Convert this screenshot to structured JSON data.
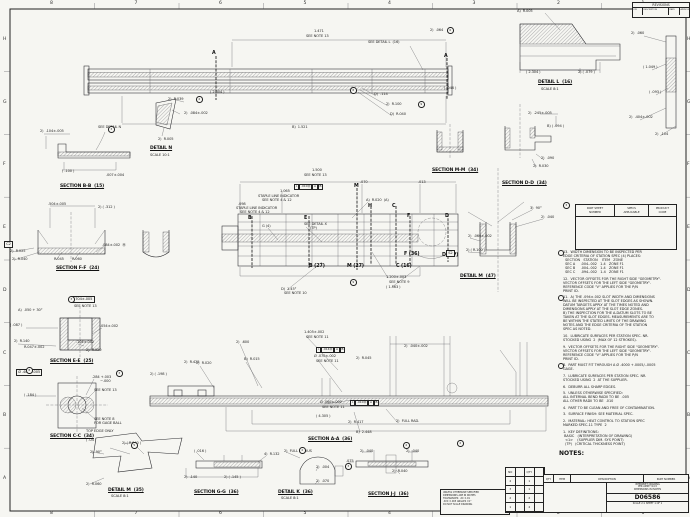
{
  "sheet": {
    "bg": "#f6f6f2",
    "line_color": "#26262a",
    "drawing_number": "D06586"
  },
  "zones": {
    "top": [
      "8",
      "7",
      "6",
      "5",
      "4",
      "3",
      "2",
      "1"
    ],
    "bottom": [
      "8",
      "7",
      "6",
      "5",
      "4",
      "3",
      "2",
      "1"
    ],
    "left": [
      "H",
      "G",
      "F",
      "E",
      "D",
      "C",
      "B",
      "A"
    ],
    "right": [
      "H",
      "G",
      "F",
      "E",
      "D",
      "C",
      "B",
      "A"
    ]
  },
  "revisions": {
    "title": "REVISIONS",
    "cols": [
      "LTR",
      "DESCRIPTION",
      "DATE",
      "APPROVED"
    ]
  },
  "spec_table": {
    "headers": [
      "PART SHEET\nNUMBER",
      "SPECS\nAPPLICABLE",
      "PRODUCT\nCODE"
    ]
  },
  "notes": {
    "heading": "NOTES:",
    "items": [
      {
        "flag": true,
        "text": "13.  WIDTH DIMENSION TO BE INSPECTED PER\nEDGE CRITERIA OF STATION SPEC (4) PLACES:\n  SECTION   STATION    ITEM   ZONE\n  SEC A     .004-.002   1-4   ZONE F1\n  SEC B     .004-.002   1-4   ZONE F1\n  SEC C     .094-.002   1-4   ZONE F1"
      },
      {
        "flag": false,
        "text": "12.  VECTOR OFFSETS FOR THE RIGHT SIDE \"GEOMETRY\".\nVECTOR OFFSETS FOR THE LEFT SIDE \"GEOMETRY\".\nREFERENCE CODE \"V\" APPLIES FOR THE P/N\nPRINT ID."
      },
      {
        "flag": true,
        "text": "11.  A) THE .094±.002 SLOT WIDTH AND DIMENSIONS\nWILL BE INSPECTED AT THE SLOT EDGES AS SHOWN.\nDATUM TARGETS APPLY AT THE TIMES NOTED AND\nDIMENSIONS APPLY AT THE SLOT EDGE ZONES.\nB) THE INSPECTION FOR THE A-DATUM SLOTS TO BE\nTAKEN AT THE SLOT EDGES. MEASUREMENTS ARE TO\nBE WITHIN THE STATED LIMITS OF THE DRAWING\nNOTES AND THE EDGE CRITERIA OF THE STATION\nSPEC AS NOTED."
      },
      {
        "flag": false,
        "text": "10.  LUBRICATE SURFACES PER STATION SPEC. NR.\nSTOCKED USING  2  (MAX OF 12 STROKES)."
      },
      {
        "flag": false,
        "text": "9.  VECTOR OFFSETS FOR THE RIGHT SIDE \"GEOMETRY\".\nVECTOR OFFSETS FOR THE LEFT SIDE \"GEOMETRY\".\nREFERENCE CODE \"V\" APPLIES FOR THE P/N\nPRINT ID."
      },
      {
        "flag": true,
        "text": "8.  PART MUST FIT THROUGH A Ø .4000 +.0005/-.0005\nGAGE."
      },
      {
        "flag": false,
        "text": "7.  LUBRICATE SURFACES PER STATION SPEC. NR.\nSTOCKED USING  2  AT THE SUPPLIER."
      },
      {
        "flag": false,
        "text": "6.  DEBURR ALL SHARP EDGES."
      },
      {
        "flag": false,
        "text": "5.  UNLESS OTHERWISE SPECIFIED:\nALL INTERNAL BEND RADII TO BE  .005\nALL OTHER RADII TO BE  .010"
      },
      {
        "flag": false,
        "text": "4.  PART TO BE CLEAN AND FREE OF CONTAMINATION."
      },
      {
        "flag": false,
        "text": "3.  SURFACE FINISH: SEE MATERIAL SPEC."
      },
      {
        "flag": false,
        "text": "2.  MATERIAL: HEAT CONTROL TO STATION SPEC\nMARKED SPEC-11 TYPE  2"
      },
      {
        "flag": false,
        "text": "1.  KEY DEFINITIONS:\n BASIC   (INTERPRETATION OF DRAWING)\n  <1>    (SUPPLIER DIM. SYS POINT)\n  (TP)   (CRITICAL THICKNESS POINT)"
      }
    ]
  },
  "labels": [
    {
      "t": "1.471",
      "x": 314,
      "y": 30
    },
    {
      "t": "SEE NOTE 13",
      "x": 306,
      "y": 35
    },
    {
      "t": "SEE DETAIL L  (16)",
      "x": 368,
      "y": 41
    },
    {
      "t": "2)  .064",
      "x": 430,
      "y": 29
    },
    {
      "t": "( 2.304 )",
      "x": 210,
      "y": 91
    },
    {
      "t": "B)  1.521",
      "x": 292,
      "y": 126
    },
    {
      "t": "D)  .114",
      "x": 374,
      "y": 93
    },
    {
      "t": "2)  R.100",
      "x": 386,
      "y": 103
    },
    {
      "t": "D)  R.040",
      "x": 390,
      "y": 113
    },
    {
      "t": "( .046 )",
      "x": 444,
      "y": 87
    },
    {
      "t": "A",
      "x": 212,
      "y": 52,
      "k": "cut"
    },
    {
      "t": "A",
      "x": 444,
      "y": 55,
      "k": "cut"
    },
    {
      "t": "A)  R.005",
      "x": 517,
      "y": 10
    },
    {
      "t": "2)  .060",
      "x": 631,
      "y": 32
    },
    {
      "t": "( 1.049 )",
      "x": 643,
      "y": 66
    },
    {
      "t": "( .093 )",
      "x": 649,
      "y": 91
    },
    {
      "t": "2)  .404±.002",
      "x": 629,
      "y": 116
    },
    {
      "t": "2)  .104",
      "x": 655,
      "y": 133
    },
    {
      "t": "( 2.304 )",
      "x": 526,
      "y": 71
    },
    {
      "t": "2) ( .079 )",
      "x": 578,
      "y": 71
    },
    {
      "t": "DETAIL L  (16)",
      "x": 538,
      "y": 81,
      "k": "sec"
    },
    {
      "t": "SCALE 8:1",
      "x": 541,
      "y": 88
    },
    {
      "t": "SEE DETAIL N",
      "x": 98,
      "y": 126
    },
    {
      "t": "2)  .104±.005",
      "x": 40,
      "y": 130
    },
    {
      "t": "( .100 )",
      "x": 62,
      "y": 170
    },
    {
      "t": ".007±.004",
      "x": 106,
      "y": 174
    },
    {
      "t": "SECTION B-B  (15)",
      "x": 60,
      "y": 185,
      "k": "sec"
    },
    {
      "t": "2)  R.039",
      "x": 168,
      "y": 98
    },
    {
      "t": "2)  .084±.002",
      "x": 184,
      "y": 112
    },
    {
      "t": "2)  R.005",
      "x": 158,
      "y": 138
    },
    {
      "t": "DETAIL N",
      "x": 150,
      "y": 147,
      "k": "sec"
    },
    {
      "t": "SCALE 10:1",
      "x": 150,
      "y": 154
    },
    {
      "t": "SECTION M-M  (34)",
      "x": 432,
      "y": 169,
      "k": "sec"
    },
    {
      "t": "2)  .245±.005",
      "x": 528,
      "y": 112
    },
    {
      "t": "B) ( .094 )",
      "x": 547,
      "y": 125
    },
    {
      "t": "2)  .090",
      "x": 541,
      "y": 157
    },
    {
      "t": "2)  R.030",
      "x": 533,
      "y": 165
    },
    {
      "t": "SECTION D-D  (34)",
      "x": 502,
      "y": 182,
      "k": "sec"
    },
    {
      "t": "1.500",
      "x": 312,
      "y": 169
    },
    {
      "t": "SEE NOTE 13",
      "x": 304,
      "y": 174
    },
    {
      "t": ".070",
      "x": 360,
      "y": 181
    },
    {
      "t": ".013",
      "x": 418,
      "y": 181
    },
    {
      "t": "1.065",
      "x": 280,
      "y": 190
    },
    {
      "t": "STAPLE LINE INDICATOR",
      "x": 258,
      "y": 195
    },
    {
      "t": "SEE NOTE 4 & 12",
      "x": 262,
      "y": 199
    },
    {
      "t": ".098",
      "x": 238,
      "y": 203
    },
    {
      "t": "STAPLE LINE INDICATOR",
      "x": 236,
      "y": 207
    },
    {
      "t": "SEE NOTE 4 & 12",
      "x": 240,
      "y": 211
    },
    {
      "t": "A)  R.020  (A)",
      "x": 366,
      "y": 199
    },
    {
      "t": "SEE DETAIL X",
      "x": 304,
      "y": 223
    },
    {
      "t": "(TP)",
      "x": 310,
      "y": 227
    },
    {
      "t": "G (4)",
      "x": 262,
      "y": 225
    },
    {
      "t": "1.200±.003",
      "x": 386,
      "y": 276
    },
    {
      "t": "SEE NOTE 9",
      "x": 389,
      "y": 281
    },
    {
      "t": "( 1.563 )",
      "x": 386,
      "y": 286
    },
    {
      "t": "D)  1.45°",
      "x": 281,
      "y": 288
    },
    {
      "t": "SEE NOTE 10",
      "x": 284,
      "y": 292
    },
    {
      "t": "B",
      "x": 248,
      "y": 217,
      "k": "cut"
    },
    {
      "t": "E",
      "x": 304,
      "y": 217,
      "k": "cut"
    },
    {
      "t": "M",
      "x": 354,
      "y": 185,
      "k": "cut"
    },
    {
      "t": "H",
      "x": 368,
      "y": 205,
      "k": "cut"
    },
    {
      "t": "C",
      "x": 392,
      "y": 205,
      "k": "cut"
    },
    {
      "t": "F",
      "x": 407,
      "y": 215,
      "k": "cut"
    },
    {
      "t": "D",
      "x": 445,
      "y": 215,
      "k": "cut"
    },
    {
      "t": "B (27)",
      "x": 309,
      "y": 265,
      "k": "cut"
    },
    {
      "t": "M (27)",
      "x": 347,
      "y": 265,
      "k": "cut"
    },
    {
      "t": "C (16)",
      "x": 396,
      "y": 265,
      "k": "cut"
    },
    {
      "t": "F (36)",
      "x": 404,
      "y": 253,
      "k": "cut"
    },
    {
      "t": "D (TP)",
      "x": 442,
      "y": 254,
      "k": "cut"
    },
    {
      "t": ".504±.005",
      "x": 48,
      "y": 203
    },
    {
      "t": "2) ( .312 )",
      "x": 98,
      "y": 206
    },
    {
      "t": ".084±.002  Ⓜ",
      "x": 102,
      "y": 244
    },
    {
      "t": "2)  R.025",
      "x": 10,
      "y": 250
    },
    {
      "t": "2)  R.040",
      "x": 12,
      "y": 258
    },
    {
      "t": "R.045",
      "x": 54,
      "y": 258
    },
    {
      "t": "R.060",
      "x": 72,
      "y": 258
    },
    {
      "t": "SECTION F-F  (24)",
      "x": 56,
      "y": 267,
      "k": "sec"
    },
    {
      "t": "C2",
      "x": 4,
      "y": 241,
      "k": "box"
    },
    {
      "t": ".704±.005",
      "x": 72,
      "y": 296,
      "k": "box"
    },
    {
      "t": "SEE NOTE 13",
      "x": 74,
      "y": 305
    },
    {
      "t": "A)  .050 + 30°",
      "x": 18,
      "y": 309
    },
    {
      "t": "( .087 )",
      "x": 10,
      "y": 324
    },
    {
      "t": ".054±.002",
      "x": 100,
      "y": 325
    },
    {
      "t": "2)  R.140",
      "x": 14,
      "y": 340
    },
    {
      "t": "R.047±.002",
      "x": 24,
      "y": 346
    },
    {
      "t": ".104±.002",
      "x": 76,
      "y": 341
    },
    {
      "t": "2)  R.020",
      "x": 86,
      "y": 349
    },
    {
      "t": "SECTION E-E  (25)",
      "x": 50,
      "y": 360,
      "k": "sec"
    },
    {
      "t": "Ø .400±.005",
      "x": 16,
      "y": 369,
      "k": "box"
    },
    {
      "t": ".284 +.003",
      "x": 92,
      "y": 376
    },
    {
      "t": "−.000",
      "x": 100,
      "y": 380
    },
    {
      "t": "SEE NOTE 13",
      "x": 94,
      "y": 389
    },
    {
      "t": "( .184 )",
      "x": 24,
      "y": 394
    },
    {
      "t": "SEE NOTE 8",
      "x": 94,
      "y": 418
    },
    {
      "t": "FOR GAGE BALL",
      "x": 94,
      "y": 422
    },
    {
      "t": "SECTION C-C  (34)",
      "x": 50,
      "y": 435,
      "k": "sec"
    },
    {
      "t": "3)  90°",
      "x": 530,
      "y": 207
    },
    {
      "t": "2)  .040",
      "x": 541,
      "y": 216
    },
    {
      "t": "2)  .060±.002",
      "x": 468,
      "y": 235
    },
    {
      "t": "2) ( R.100 )",
      "x": 466,
      "y": 249
    },
    {
      "t": "S2",
      "x": 446,
      "y": 250,
      "k": "box"
    },
    {
      "t": "DETAIL M  (47)",
      "x": 460,
      "y": 275,
      "k": "sec"
    },
    {
      "t": "2)  .600",
      "x": 236,
      "y": 341
    },
    {
      "t": "1.405±.002",
      "x": 304,
      "y": 331
    },
    {
      "t": "SEE NOTE 11",
      "x": 306,
      "y": 336
    },
    {
      "t": "B)  R.015",
      "x": 244,
      "y": 358
    },
    {
      "t": "2)  R.020",
      "x": 196,
      "y": 362
    },
    {
      "t": "2) ( .198 )",
      "x": 150,
      "y": 373
    },
    {
      "t": "2)  R.425",
      "x": 184,
      "y": 361
    },
    {
      "t": "Ø .070±.002",
      "x": 314,
      "y": 355
    },
    {
      "t": "SEE NOTE 11",
      "x": 316,
      "y": 360
    },
    {
      "t": "2)  R.045",
      "x": 356,
      "y": 357
    },
    {
      "t": "2)  .040±.002",
      "x": 404,
      "y": 345
    },
    {
      "t": "Ø .060±.002",
      "x": 320,
      "y": 401
    },
    {
      "t": "SEE NOTE 11",
      "x": 322,
      "y": 406
    },
    {
      "t": "( 4.305 )",
      "x": 316,
      "y": 415
    },
    {
      "t": "2)  R.417",
      "x": 348,
      "y": 421
    },
    {
      "t": "2)  FULL RAD.",
      "x": 396,
      "y": 420
    },
    {
      "t": "B)  2.448",
      "x": 356,
      "y": 431
    },
    {
      "t": "SECTION A-A  (36)",
      "x": 308,
      "y": 438,
      "k": "sec"
    },
    {
      "t": "2)  .040",
      "x": 360,
      "y": 450
    },
    {
      "t": "2)  .040",
      "x": 406,
      "y": 450
    },
    {
      "t": ".075",
      "x": 346,
      "y": 460
    },
    {
      "t": "2)  R.040",
      "x": 392,
      "y": 470
    },
    {
      "t": "SECTION J-J  (36)",
      "x": 368,
      "y": 493,
      "k": "sec"
    },
    {
      "t": "( .016 )",
      "x": 194,
      "y": 450
    },
    {
      "t": "4)  R.132",
      "x": 264,
      "y": 453
    },
    {
      "t": "2)  .140",
      "x": 184,
      "y": 476
    },
    {
      "t": "2) ( .145 )",
      "x": 224,
      "y": 476
    },
    {
      "t": "SECTION G-G  (36)",
      "x": 194,
      "y": 491,
      "k": "sec"
    },
    {
      "t": "2)  FULL RADIUS",
      "x": 284,
      "y": 450
    },
    {
      "t": "2)  .004",
      "x": 316,
      "y": 466
    },
    {
      "t": "2)  .070",
      "x": 316,
      "y": 480
    },
    {
      "t": "DETAIL K  (36)",
      "x": 278,
      "y": 491,
      "k": "sec"
    },
    {
      "t": "SCALE 8:1",
      "x": 281,
      "y": 497
    },
    {
      "t": "TOP EDGE ONLY",
      "x": 86,
      "y": 430
    },
    {
      "t": "( .04 )",
      "x": 86,
      "y": 439
    },
    {
      "t": "2) ( R.040 )",
      "x": 122,
      "y": 442
    },
    {
      "t": "2)  90°",
      "x": 90,
      "y": 451
    },
    {
      "t": "2)  R.060",
      "x": 86,
      "y": 483
    },
    {
      "t": "DETAIL M  (35)",
      "x": 108,
      "y": 489,
      "k": "sec"
    },
    {
      "t": "SCALE 8:1",
      "x": 111,
      "y": 495
    }
  ],
  "flags": [
    {
      "x": 447,
      "y": 27,
      "t": "6"
    },
    {
      "x": 418,
      "y": 101,
      "t": "9"
    },
    {
      "x": 350,
      "y": 87,
      "t": "8"
    },
    {
      "x": 108,
      "y": 126,
      "t": "3"
    },
    {
      "x": 196,
      "y": 96,
      "t": "2"
    },
    {
      "x": 68,
      "y": 296,
      "t": "3"
    },
    {
      "x": 26,
      "y": 367,
      "t": "8"
    },
    {
      "x": 116,
      "y": 370,
      "t": "3"
    },
    {
      "x": 350,
      "y": 279,
      "t": "9"
    },
    {
      "x": 563,
      "y": 202,
      "t": "3"
    },
    {
      "x": 131,
      "y": 442,
      "t": "5"
    },
    {
      "x": 299,
      "y": 447,
      "t": "2"
    },
    {
      "x": 345,
      "y": 463,
      "t": "3"
    },
    {
      "x": 403,
      "y": 442,
      "t": "2"
    },
    {
      "x": 457,
      "y": 440,
      "t": "2"
    }
  ],
  "gdt": [
    {
      "x": 294,
      "y": 184,
      "cells": [
        "⌖",
        ".010Ⓜ",
        "A",
        "B"
      ]
    },
    {
      "x": 316,
      "y": 347,
      "cells": [
        "⌖",
        ".014Ⓜ",
        "A",
        "B"
      ]
    },
    {
      "x": 350,
      "y": 400,
      "cells": [
        "⌖",
        ".010Ⓜ",
        "A",
        "B"
      ]
    }
  ],
  "title_block": {
    "parts_strip": [
      "QTY",
      "ITEM",
      "DESCRIPTION",
      "PART NUMBER"
    ],
    "tol_lines": [
      "UNLESS OTHERWISE SPECIFIED",
      "DIMENSIONS ARE IN INCHES",
      "TOLERANCES:  .XX ±.01",
      ".XXX ±.005   ANGLES ±1°",
      "DO NOT SCALE DRAWING"
    ],
    "company_lines": [
      "INTERPRET DRAWING",
      "PER ASME Y14.5",
      "DIMENSIONS IN INCHES"
    ],
    "dwg_no": "D06586",
    "scale_line": "SCALE 2:1        SHEET 1 OF 1",
    "qty": {
      "headers": [
        "NO",
        "QTY"
      ],
      "rows": [
        [
          "4",
          "1"
        ],
        [
          "3",
          "1"
        ],
        [
          "2",
          "2"
        ],
        [
          "1",
          "4"
        ]
      ]
    }
  }
}
